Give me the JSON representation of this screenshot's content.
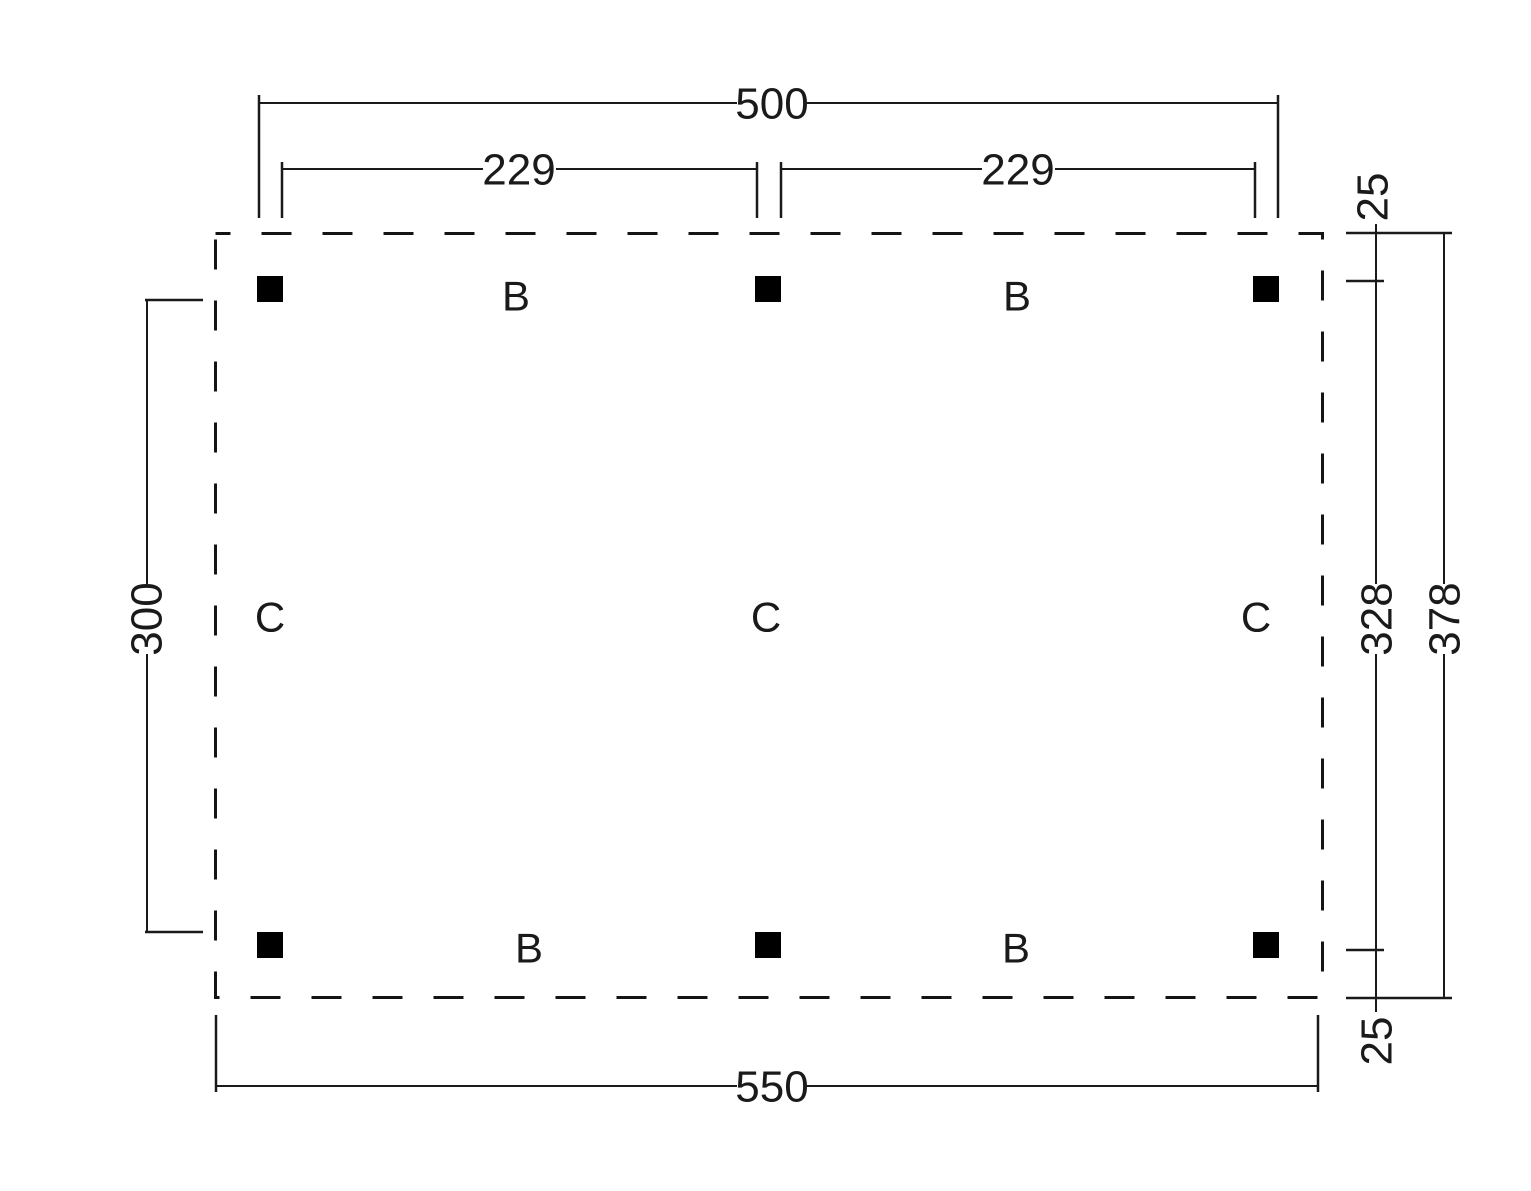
{
  "drawing": {
    "background": "#ffffff",
    "ink_color": "#1a1a1a",
    "post_color": "#000000",
    "outline_style": "dashed",
    "dimensions": {
      "top_overall": "500",
      "top_bay_left": "229",
      "top_bay_right": "229",
      "right_offset_top": "25",
      "right_post_span": "328",
      "right_overall": "378",
      "right_offset_bottom": "25",
      "left_post_clearance": "300",
      "bottom_overall": "550"
    },
    "beam_labels": [
      "B",
      "B",
      "B",
      "B"
    ],
    "column_labels": [
      "C",
      "C",
      "C"
    ],
    "post_markers": {
      "shape": "filled-square",
      "count": 6
    }
  }
}
